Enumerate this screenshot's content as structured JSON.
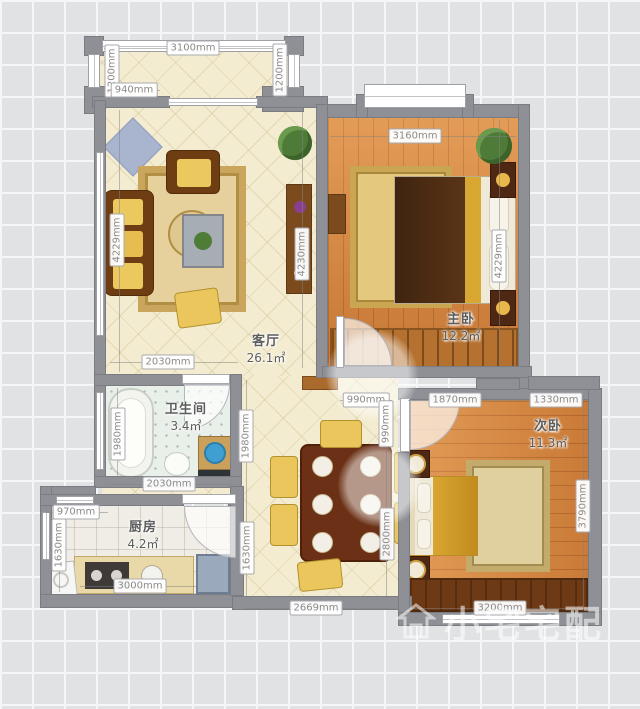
{
  "watermark": {
    "text": "小宅宅配",
    "icon": "house-logo"
  },
  "rooms": [
    {
      "id": "living-room",
      "name": "客厅",
      "area": "26.1㎡",
      "x": 266,
      "y": 348
    },
    {
      "id": "master-bedroom",
      "name": "主卧",
      "area": "12.2㎡",
      "x": 461,
      "y": 326
    },
    {
      "id": "second-bedroom",
      "name": "次卧",
      "area": "11.3㎡",
      "x": 548,
      "y": 433
    },
    {
      "id": "bathroom",
      "name": "卫生间",
      "area": "3.4㎡",
      "x": 186,
      "y": 416
    },
    {
      "id": "kitchen",
      "name": "厨房",
      "area": "4.2㎡",
      "x": 143,
      "y": 534
    }
  ],
  "dimensions": [
    {
      "text": "3100mm",
      "x": 193,
      "y": 48,
      "v": false
    },
    {
      "text": "1200mm",
      "x": 112,
      "y": 71,
      "v": true
    },
    {
      "text": "940mm",
      "x": 134,
      "y": 90,
      "v": false
    },
    {
      "text": "1200mm",
      "x": 280,
      "y": 70,
      "v": true
    },
    {
      "text": "3160mm",
      "x": 415,
      "y": 136,
      "v": false
    },
    {
      "text": "4229mm",
      "x": 117,
      "y": 240,
      "v": true
    },
    {
      "text": "4230mm",
      "x": 302,
      "y": 254,
      "v": true
    },
    {
      "text": "4229mm",
      "x": 499,
      "y": 256,
      "v": true
    },
    {
      "text": "2030mm",
      "x": 168,
      "y": 362,
      "v": false
    },
    {
      "text": "990mm",
      "x": 366,
      "y": 400,
      "v": false
    },
    {
      "text": "1870mm",
      "x": 455,
      "y": 400,
      "v": false
    },
    {
      "text": "1330mm",
      "x": 556,
      "y": 400,
      "v": false
    },
    {
      "text": "1980mm",
      "x": 118,
      "y": 434,
      "v": true
    },
    {
      "text": "990mm",
      "x": 386,
      "y": 424,
      "v": true
    },
    {
      "text": "1980mm",
      "x": 246,
      "y": 436,
      "v": true
    },
    {
      "text": "2030mm",
      "x": 169,
      "y": 484,
      "v": false
    },
    {
      "text": "970mm",
      "x": 76,
      "y": 512,
      "v": false
    },
    {
      "text": "1630mm",
      "x": 59,
      "y": 545,
      "v": true
    },
    {
      "text": "3000mm",
      "x": 140,
      "y": 586,
      "v": false
    },
    {
      "text": "1630mm",
      "x": 247,
      "y": 548,
      "v": true
    },
    {
      "text": "2800mm",
      "x": 387,
      "y": 534,
      "v": true
    },
    {
      "text": "2669mm",
      "x": 316,
      "y": 608,
      "v": false
    },
    {
      "text": "3790mm",
      "x": 583,
      "y": 506,
      "v": true
    },
    {
      "text": "3200mm",
      "x": 500,
      "y": 608,
      "v": false
    }
  ]
}
